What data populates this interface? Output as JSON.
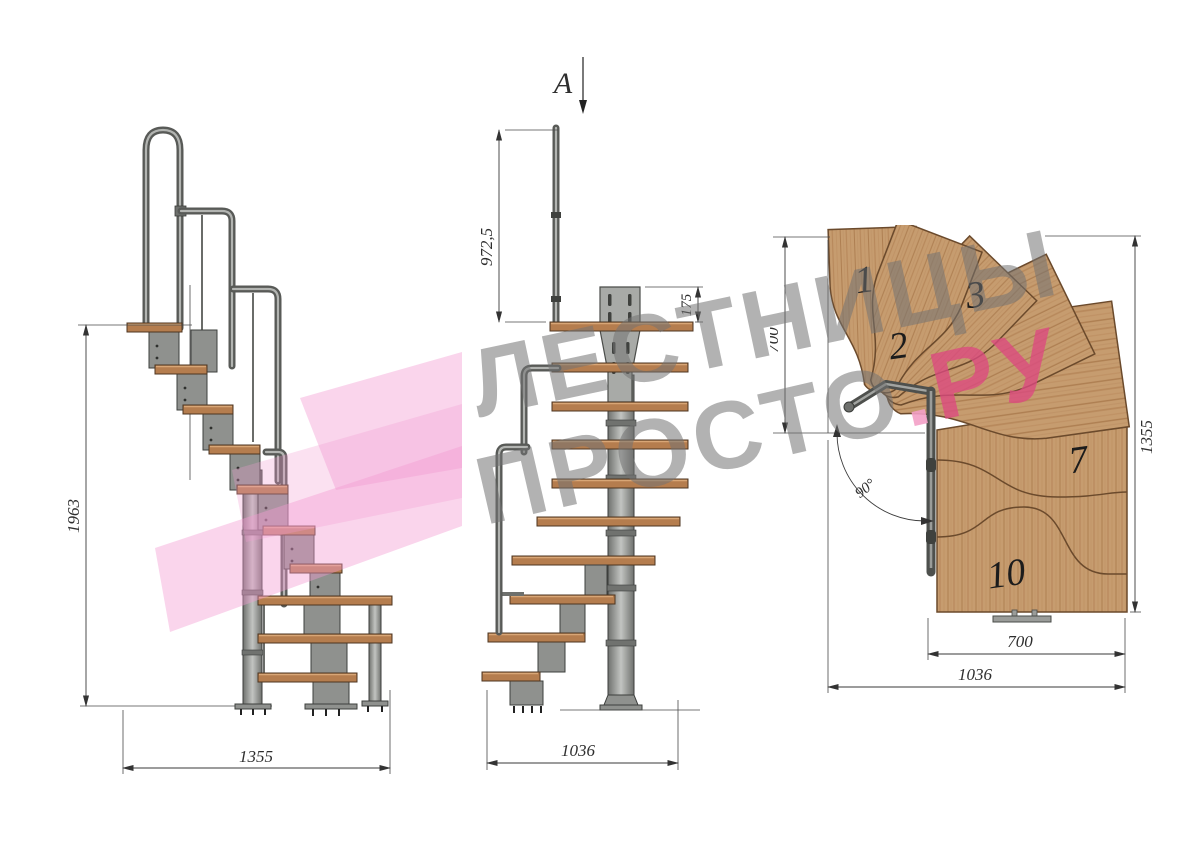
{
  "watermark": {
    "line1": "ЛЕСТНИЦЫ",
    "line2_gray": "ПРОСТО",
    "line2_dot": ".",
    "line2_pink": "РУ"
  },
  "section": {
    "label": "A"
  },
  "views": {
    "side": {
      "dim_height": "1963",
      "dim_width": "1355"
    },
    "front": {
      "dim_rail": "972,5",
      "dim_bracket": "175",
      "dim_width": "1036"
    },
    "plan": {
      "dim_depth": "700",
      "dim_total": "1355",
      "dim_tread": "700",
      "dim_width": "1036",
      "dim_angle": "90°",
      "treads": [
        "1",
        "2",
        "3",
        "7",
        "10"
      ]
    }
  },
  "colors": {
    "wood_plan": "#c69c6f",
    "wood_side": "#b57d4e",
    "metal": "#8f918e",
    "pink_logo": "#f29ad2",
    "pink_text": "#dd4980",
    "dim_text": "#2e2e2e"
  }
}
